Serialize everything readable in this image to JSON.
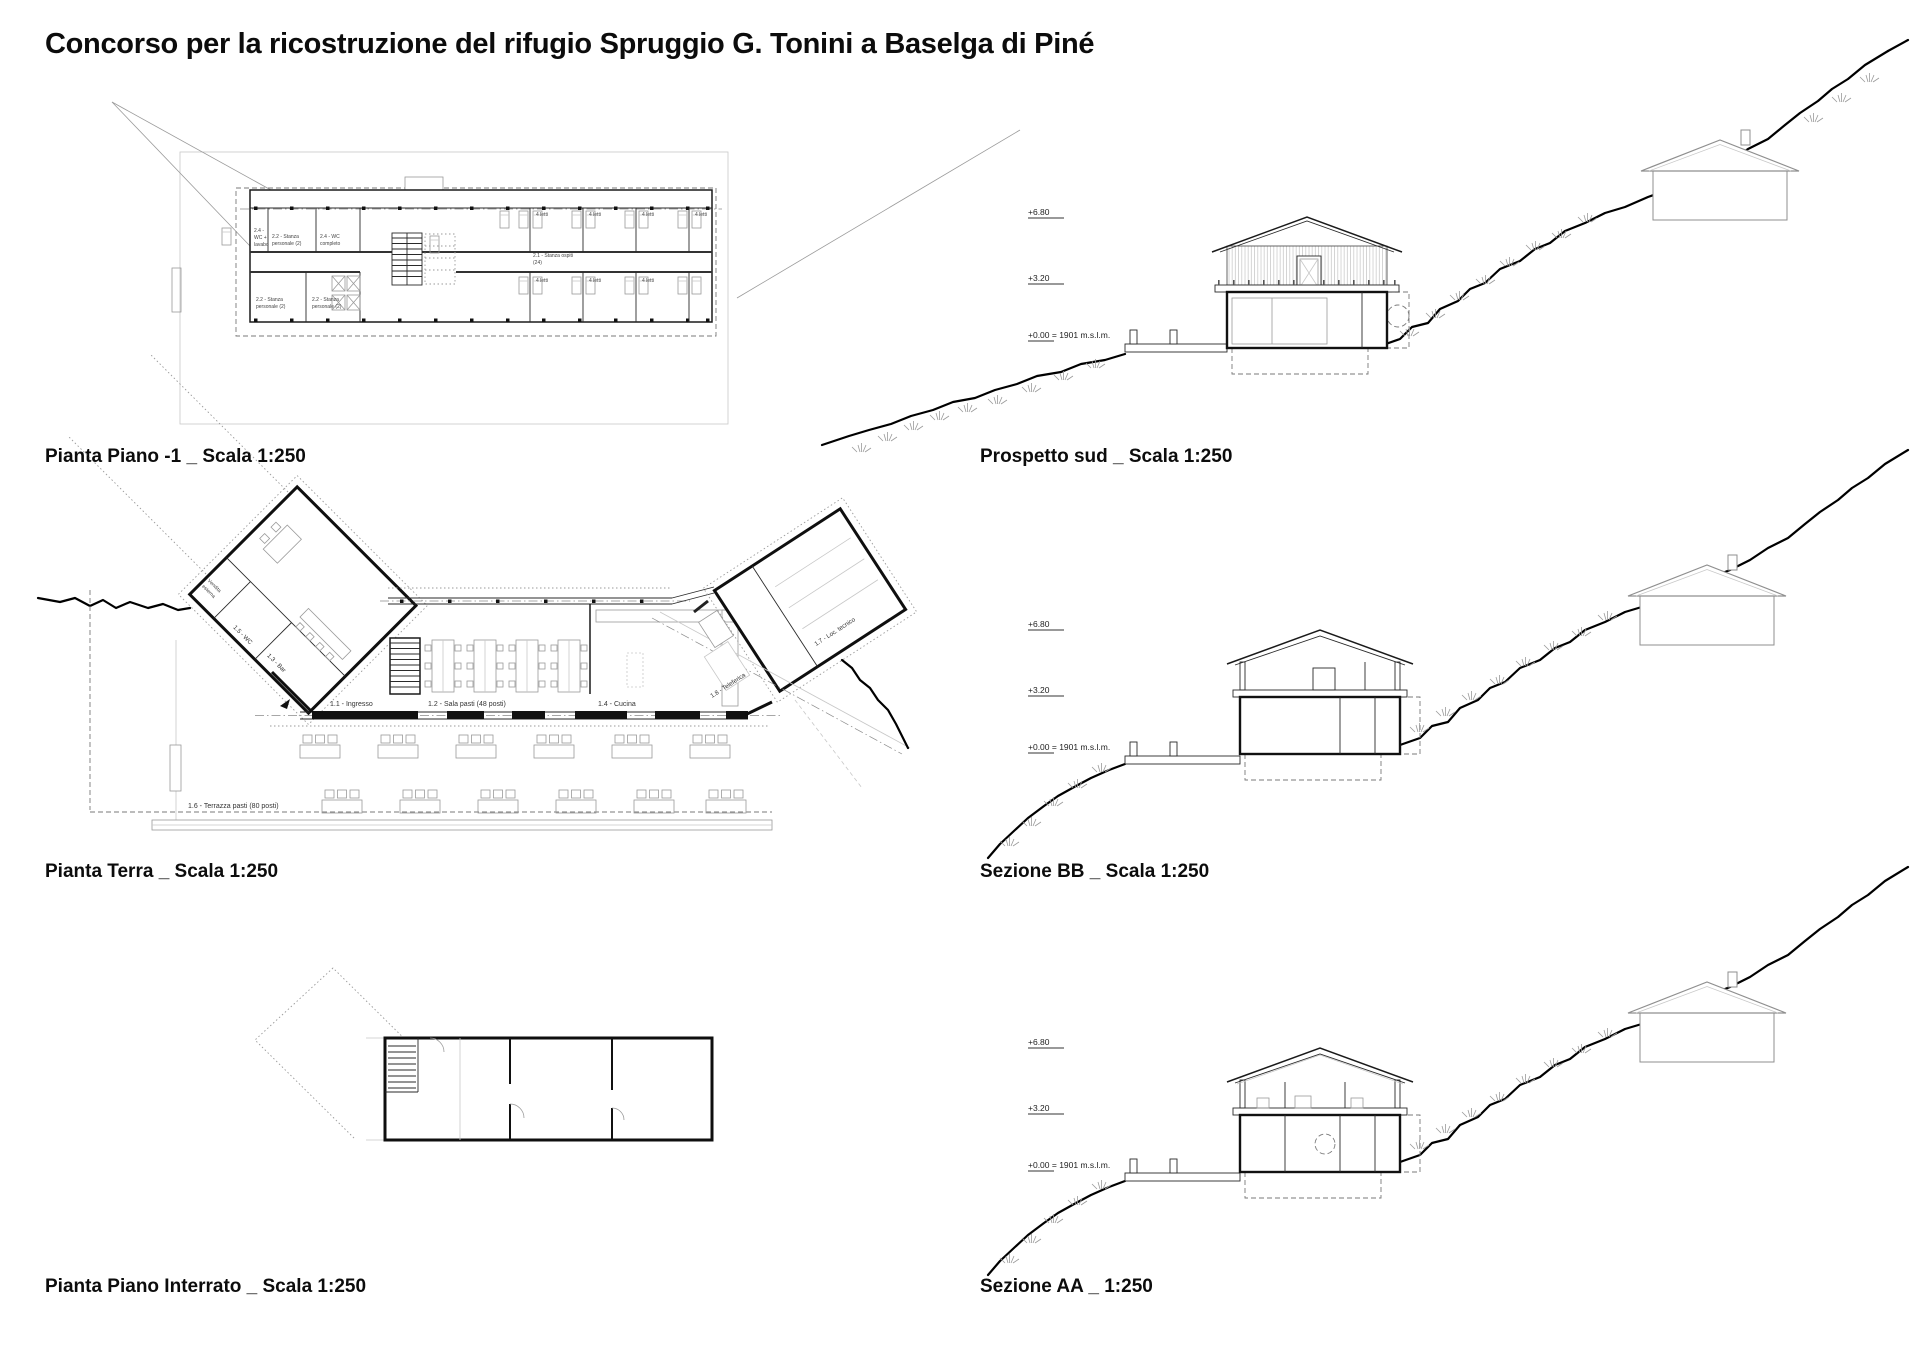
{
  "title": "Concorso per la ricostruzione del rifugio Spruggio G. Tonini a Baselga di Piné",
  "captions": {
    "pianta_piano_m1": "Pianta Piano -1 _ Scala 1:250",
    "prospetto_sud": "Prospetto sud _ Scala 1:250",
    "pianta_terra": "Pianta Terra _ Scala 1:250",
    "sezione_bb": "Sezione BB _ Scala 1:250",
    "pianta_interrato": "Pianta Piano Interrato _ Scala 1:250",
    "sezione_aa": "Sezione AA _ 1:250"
  },
  "levels": {
    "l1": "+6.80",
    "l2": "+3.20",
    "l0": "+0.00 = 1901 m.s.l.m."
  },
  "piano_m1_rooms": {
    "wc_lavabo": [
      "2.4 -",
      "WC +",
      "lavabo"
    ],
    "stanza_pers_1": [
      "2.2 - Stanza",
      "personale (2)"
    ],
    "wc_completo": [
      "2.4 - WC",
      "completo"
    ],
    "stanza_ospiti": [
      "2.1 - Stanza ospiti",
      "(24)"
    ],
    "stanza_pers_2": [
      "2.2 - Stanza",
      "personale (2)"
    ],
    "stanza_pers_3": [
      "2.2 - Stanza",
      "personale (2)"
    ],
    "letti": "4 letti"
  },
  "terra_rooms": {
    "vendita": [
      "Vendita",
      "esterna"
    ],
    "wc": "1.5 - WC",
    "bar": "1.3 - Bar",
    "ingresso": "1.1 - Ingresso",
    "sala_pasti": "1.2 - Sala pasti (48 posti)",
    "cucina": "1.4 - Cucina",
    "terrazza": "1.6 - Terrazza pasti (80 posti)",
    "loc_tecnico": "1.7 - Loc. tecnico",
    "teleferica": "1.8 - Teleferica"
  },
  "colors": {
    "ink": "#1a1a1a",
    "faint": "#c8c8c8",
    "mid": "#9a9a9a"
  }
}
